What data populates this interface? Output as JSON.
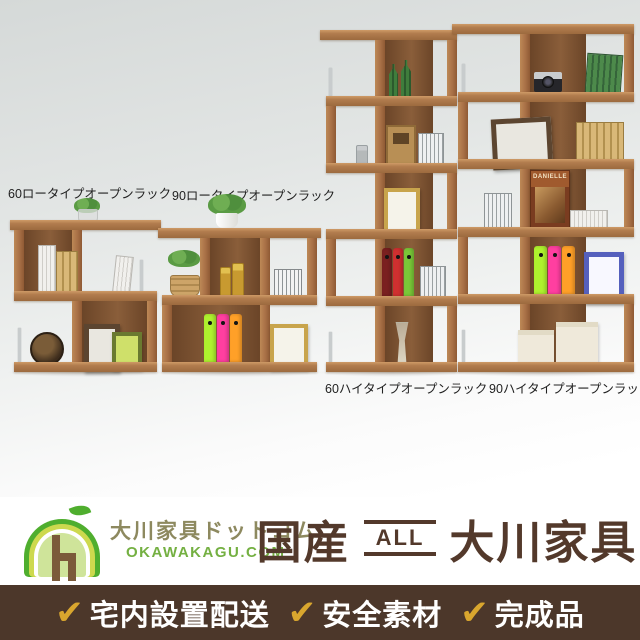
{
  "products": {
    "low60": {
      "label": "60ロータイプオープンラック"
    },
    "low90": {
      "label": "90ロータイプオープンラック"
    },
    "high60": {
      "label": "60ハイタイプオープンラック"
    },
    "high90": {
      "label": "90ハイタイプオープンラック"
    }
  },
  "decor": {
    "magazine_title": "DANIELLE"
  },
  "brand": {
    "name": "大川家具ドットコム",
    "site": "OKAWAKAGU.COM"
  },
  "headline": {
    "left": "国産",
    "badge": "ALL",
    "right": "大川家具"
  },
  "features": {
    "check_icon": "✔",
    "items": [
      {
        "label": "宅内設置配送"
      },
      {
        "label": "安全素材"
      },
      {
        "label": "完成品"
      }
    ]
  },
  "colors": {
    "wood": "#b07a4e",
    "wood_interior": "#7b5233",
    "footer_bg": "#4c372a",
    "check_gold": "#d9a62e",
    "brand_green": "#74b042",
    "brand_olive": "#8d895f",
    "headline_brown": "#53392b",
    "logo_green": "#4fae2e",
    "logo_yellow_green": "#cdd94e"
  }
}
